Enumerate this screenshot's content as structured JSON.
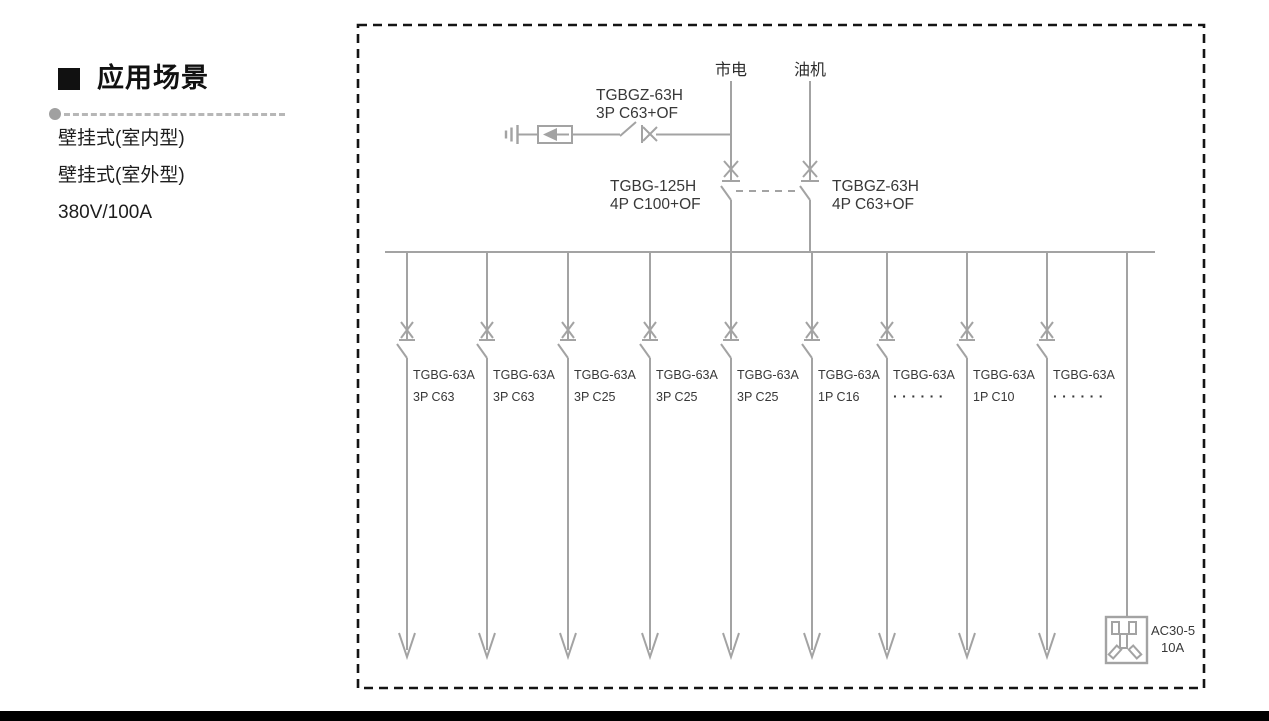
{
  "left_panel": {
    "heading": "应用场景",
    "items": [
      "壁挂式(室内型)",
      "壁挂式(室外型)",
      "380V/100A"
    ]
  },
  "diagram": {
    "source_labels": [
      "市电",
      "油机"
    ],
    "spd_breaker": {
      "line1": "TGBGZ-63H",
      "line2": "3P C63+OF"
    },
    "transfer": {
      "left": {
        "line1": "TGBG-125H",
        "line2": "4P C100+OF"
      },
      "right": {
        "line1": "TGBGZ-63H",
        "line2": "4P C63+OF"
      }
    },
    "branches": [
      {
        "model": "TGBG-63A",
        "rating": "3P C63"
      },
      {
        "model": "TGBG-63A",
        "rating": "3P C63"
      },
      {
        "model": "TGBG-63A",
        "rating": "3P C25"
      },
      {
        "model": "TGBG-63A",
        "rating": "3P C25"
      },
      {
        "model": "TGBG-63A",
        "rating": "3P C25"
      },
      {
        "model": "TGBG-63A",
        "rating": "1P C16"
      },
      {
        "model": "TGBG-63A",
        "rating": "······"
      },
      {
        "model": "TGBG-63A",
        "rating": "1P C10"
      },
      {
        "model": "TGBG-63A",
        "rating": "······"
      }
    ],
    "socket": {
      "model": "AC30-5",
      "rating": "10A"
    }
  },
  "colors": {
    "diagram_line": "#a3a3a3",
    "diagram_text": "#383838",
    "border": "#141414"
  }
}
